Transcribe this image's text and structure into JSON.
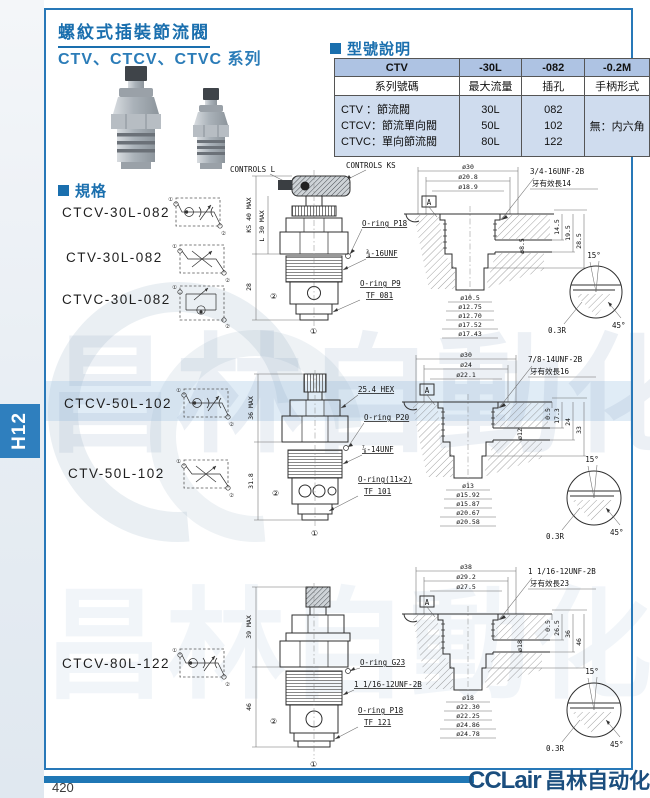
{
  "page": {
    "number": "420",
    "tab": "H12"
  },
  "brand": {
    "latin": "CCLair",
    "cjk": "昌林自动化"
  },
  "watermark": {
    "text": "昌林自動化"
  },
  "header": {
    "title": "螺紋式插裝節流閥",
    "subtitle": "CTV、CTCV、CTVC 系列"
  },
  "model_table": {
    "heading": "型號說明",
    "header_row": [
      "CTV",
      "-30L",
      "-082",
      "-0.2M"
    ],
    "label_row": [
      "系列號碼",
      "最大流量",
      "插孔",
      "手柄形式"
    ],
    "series": [
      "CTV ：節流閥",
      "CTCV：節流單向閥",
      "CTVC：單向節流閥"
    ],
    "flows": [
      "30L",
      "50L",
      "80L"
    ],
    "holes": [
      "082",
      "102",
      "122"
    ],
    "handle": "無：内六角"
  },
  "spec": {
    "heading": "規格",
    "icon_ports": [
      "①",
      "②"
    ],
    "models": [
      "CTCV-30L-082",
      "CTV-30L-082",
      "CTVC-30L-082",
      "CTCV-50L-102",
      "CTV-50L-102",
      "CTCV-80L-122"
    ]
  },
  "drawings": {
    "d30": {
      "controls_l": "CONTROLS L",
      "controls_ks": "CONTROLS KS",
      "dims": {
        "height_ks": "KS 40 MAX",
        "height_l": "L 30 MAX",
        "body_len": "28"
      },
      "labels": {
        "oring_top": "O-ring P18",
        "thread": "¾-16UNF",
        "oring_bottom": "O-ring P9",
        "tf": "TF 081"
      },
      "ports": {
        "side": "②",
        "bottom": "①"
      },
      "cavity": {
        "top_dims": [
          "ø30",
          "ø20.8",
          "ø18.9"
        ],
        "thread": "3/4-16UNF-2B",
        "thread_note": "牙有效長14",
        "datum": "A",
        "depth_dims": [
          "14.5",
          "19.5",
          "28.5"
        ],
        "side_dim": "ø8.5",
        "bottom_dims": [
          "ø10.5",
          "ø12.75",
          "ø12.70",
          "ø17.52",
          "ø17.43"
        ],
        "detail": {
          "top_angle": "15°",
          "radius": "0.3R",
          "chamfer": "45°"
        }
      }
    },
    "d50": {
      "dims": {
        "height": "36 MAX",
        "body_len": "31.8"
      },
      "labels": {
        "hex": "25.4 HEX",
        "oring_top": "O-ring P20",
        "thread": "⅞-14UNF",
        "oring_bottom": "O-ring(11×2)",
        "tf": "TF 101"
      },
      "ports": {
        "side": "②",
        "bottom": "①"
      },
      "cavity": {
        "top_dims": [
          "ø30",
          "ø24",
          "ø22.1"
        ],
        "thread": "7/8-14UNF-2B",
        "thread_note": "牙有效長16",
        "datum": "A",
        "depth_dims": [
          "0.5",
          "17.3",
          "24",
          "33"
        ],
        "side_dim": "ø12",
        "bottom_dims": [
          "ø13",
          "ø15.92",
          "ø15.87",
          "ø20.67",
          "ø20.58"
        ],
        "detail": {
          "top_angle": "15°",
          "radius": "0.3R",
          "chamfer": "45°"
        }
      }
    },
    "d80": {
      "dims": {
        "height": "39 MAX",
        "body_len": "46"
      },
      "labels": {
        "oring_top": "O-ring G23",
        "thread": "1 1/16-12UNF-2B",
        "oring_bottom": "O-ring P18",
        "tf": "TF 121"
      },
      "ports": {
        "side": "②",
        "bottom": "①"
      },
      "cavity": {
        "top_dims": [
          "ø38",
          "ø29.2",
          "ø27.5"
        ],
        "thread": "1 1/16-12UNF-2B",
        "thread_note": "牙有效長23",
        "datum": "A",
        "depth_dims": [
          "0.5",
          "26.5",
          "36",
          "46"
        ],
        "side_dim": "ø18",
        "bottom_dims": [
          "ø18",
          "ø22.30",
          "ø22.25",
          "ø24.86",
          "ø24.78"
        ],
        "detail": {
          "top_angle": "15°",
          "radius": "0.3R",
          "chamfer": "45°"
        }
      }
    }
  }
}
